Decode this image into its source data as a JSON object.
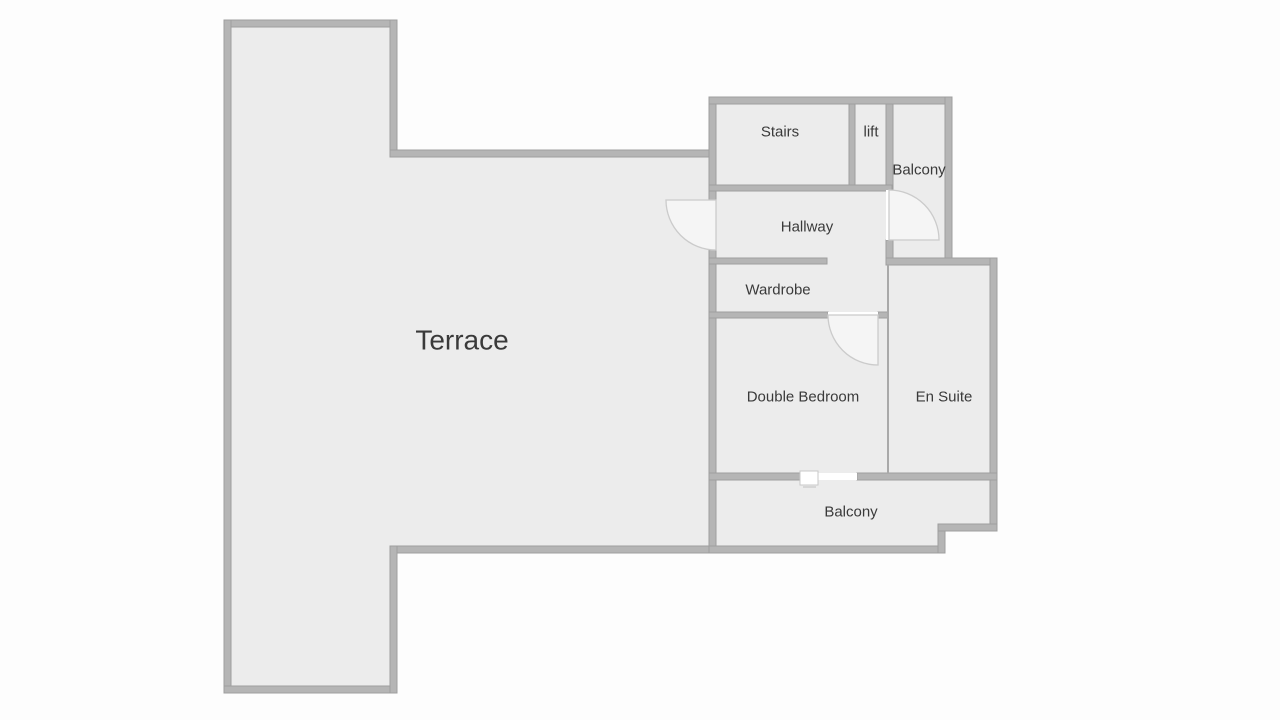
{
  "title": "First floor plan",
  "colors": {
    "background": "#fdfdfd",
    "room_fill": "#ececec",
    "wall_fill": "#b5b5b5",
    "wall_edge": "#9e9e9e",
    "partition": "#a9a9a9",
    "gap": "#ffffff",
    "door_fill": "#f5f5f5",
    "door_stroke": "#cbcbcb",
    "window_fill": "#ffffff",
    "window_stroke": "#c9c9c9",
    "window_dash": "#d6d6d6",
    "text": "#3a3a3a"
  },
  "rooms": [
    {
      "id": "terrace",
      "label": "Terrace",
      "x": 462,
      "y": 340,
      "font_size": 28
    },
    {
      "id": "stairs",
      "label": "Stairs",
      "x": 780,
      "y": 132,
      "font_size": 15
    },
    {
      "id": "lift",
      "label": "lift",
      "x": 871,
      "y": 132,
      "font_size": 15
    },
    {
      "id": "balcony-top",
      "label": "Balcony",
      "x": 919,
      "y": 170,
      "font_size": 15
    },
    {
      "id": "hallway",
      "label": "Hallway",
      "x": 807,
      "y": 227,
      "font_size": 15
    },
    {
      "id": "wardrobe",
      "label": "Wardrobe",
      "x": 778,
      "y": 290,
      "font_size": 15
    },
    {
      "id": "double-bedroom",
      "label": "Double Bedroom",
      "x": 803,
      "y": 397,
      "font_size": 15
    },
    {
      "id": "en-suite",
      "label": "En Suite",
      "x": 944,
      "y": 397,
      "font_size": 15
    },
    {
      "id": "balcony-bottom",
      "label": "Balcony",
      "x": 851,
      "y": 512,
      "font_size": 15
    }
  ],
  "floorplan": {
    "canvas": {
      "width": 1280,
      "height": 720
    },
    "floors": [
      {
        "name": "terrace-floor",
        "points": [
          [
            224,
            20
          ],
          [
            397,
            20
          ],
          [
            397,
            150
          ],
          [
            716,
            150
          ],
          [
            716,
            553
          ],
          [
            397,
            553
          ],
          [
            397,
            693
          ],
          [
            224,
            693
          ]
        ]
      },
      {
        "name": "top-block-floor",
        "points": [
          [
            709,
            97
          ],
          [
            952,
            97
          ],
          [
            952,
            265
          ],
          [
            709,
            265
          ]
        ]
      },
      {
        "name": "bedroom-block-floor",
        "points": [
          [
            709,
            258
          ],
          [
            890,
            258
          ],
          [
            890,
            480
          ],
          [
            709,
            480
          ]
        ]
      },
      {
        "name": "ensuite-floor",
        "points": [
          [
            886,
            258
          ],
          [
            997,
            258
          ],
          [
            997,
            480
          ],
          [
            886,
            480
          ]
        ]
      },
      {
        "name": "balcony-bottom-floor",
        "points": [
          [
            709,
            473
          ],
          [
            997,
            473
          ],
          [
            997,
            531
          ],
          [
            945,
            531
          ],
          [
            945,
            553
          ],
          [
            709,
            553
          ]
        ]
      }
    ],
    "walls": [
      [
        224,
        20,
        173,
        7
      ],
      [
        224,
        20,
        7,
        673
      ],
      [
        224,
        686,
        173,
        7
      ],
      [
        390,
        20,
        7,
        137
      ],
      [
        390,
        150,
        326,
        7
      ],
      [
        390,
        546,
        326,
        7
      ],
      [
        390,
        546,
        7,
        147
      ],
      [
        709,
        97,
        7,
        103
      ],
      [
        709,
        250,
        7,
        303
      ],
      [
        709,
        97,
        243,
        7
      ],
      [
        849,
        104,
        6,
        85
      ],
      [
        886,
        104,
        7,
        86
      ],
      [
        709,
        185,
        183,
        6
      ],
      [
        886,
        240,
        7,
        25
      ],
      [
        945,
        97,
        7,
        168
      ],
      [
        886,
        258,
        111,
        7
      ],
      [
        709,
        258,
        118,
        6
      ],
      [
        709,
        312,
        119,
        6
      ],
      [
        878,
        312,
        10,
        6
      ],
      [
        990,
        258,
        7,
        273
      ],
      [
        709,
        473,
        93,
        7
      ],
      [
        857,
        473,
        140,
        7
      ],
      [
        709,
        546,
        236,
        7
      ],
      [
        938,
        524,
        7,
        29
      ],
      [
        938,
        524,
        59,
        7
      ]
    ],
    "partitions": [
      [
        887,
        265,
        2,
        208
      ]
    ],
    "door_gaps": [
      [
        709,
        200,
        7,
        50
      ],
      [
        886,
        190,
        7,
        50
      ],
      [
        828,
        312,
        50,
        6
      ],
      [
        802,
        473,
        55,
        7
      ]
    ],
    "doors": [
      {
        "name": "terrace-door",
        "hinge": [
          716,
          200
        ],
        "start": [
          666,
          200
        ],
        "end": [
          716,
          250
        ],
        "r": 50,
        "sweep": 0
      },
      {
        "name": "balcony-top-door",
        "hinge": [
          889,
          240
        ],
        "start": [
          889,
          190
        ],
        "end": [
          939,
          240
        ],
        "r": 50,
        "sweep": 1
      },
      {
        "name": "bedroom-door",
        "hinge": [
          878,
          315
        ],
        "start": [
          828,
          315
        ],
        "end": [
          878,
          365
        ],
        "r": 50,
        "sweep": 0
      }
    ],
    "window_markers": [
      {
        "name": "balcony-slider",
        "rect": [
          800,
          471,
          18,
          14
        ],
        "dash": [
          803,
          486,
          13,
          2
        ]
      }
    ]
  }
}
